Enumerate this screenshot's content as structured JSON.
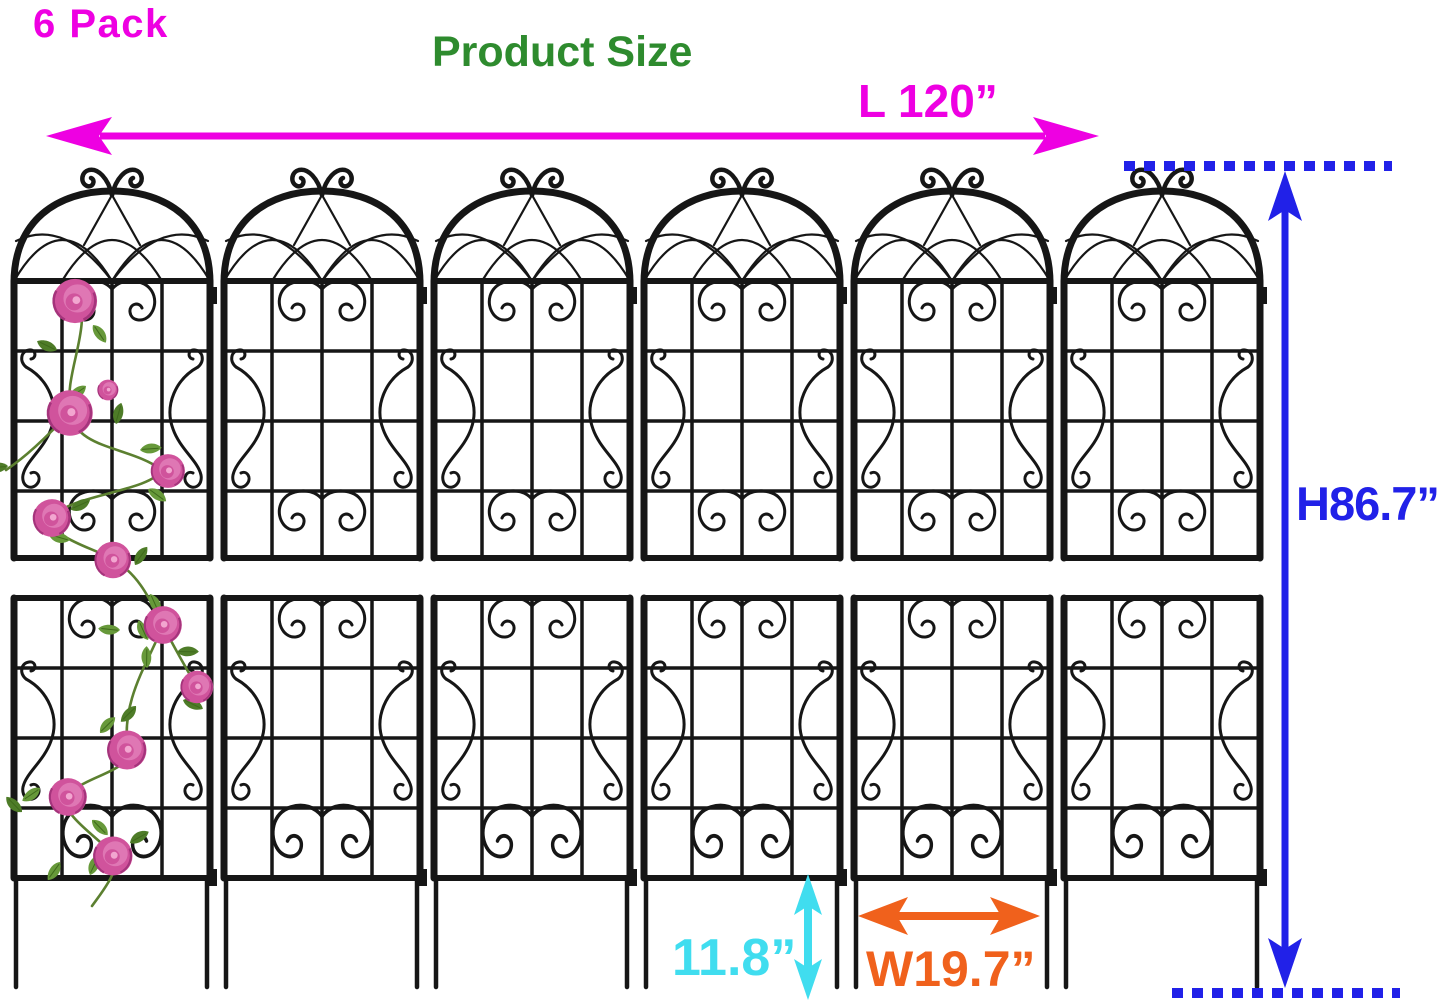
{
  "labels": {
    "pack_count": "6 Pack",
    "title": "Product Size",
    "length": "L 120”",
    "height": "H86.7”",
    "leg_height": "11.8”",
    "panel_width": "W19.7”"
  },
  "product": {
    "panel_count": 6,
    "rose_vine_on_first_panel": true,
    "rose_count": 11
  },
  "colors": {
    "magenta": "#ee00e2",
    "green": "#2e8b2e",
    "blue": "#2121e8",
    "cyan": "#40ddef",
    "orange": "#f0611c",
    "iron_black": "#161616",
    "rose_pink": "#d0539c",
    "leaf_green": "#67993a"
  }
}
